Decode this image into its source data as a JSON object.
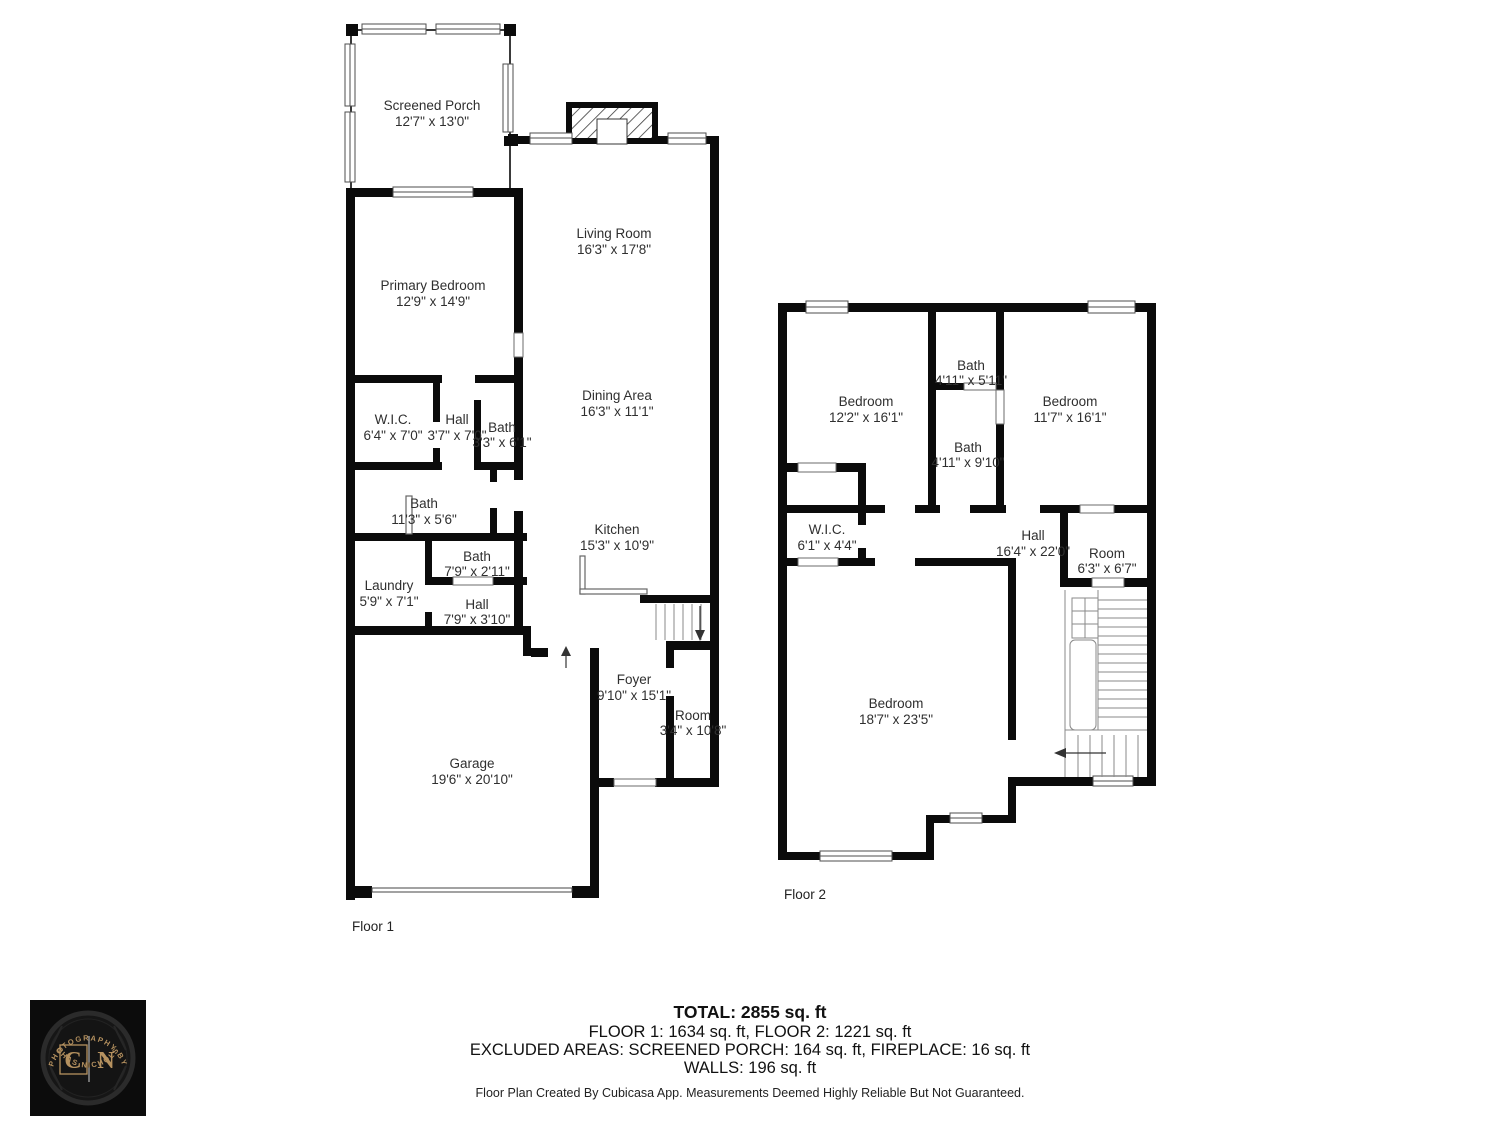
{
  "floor1": {
    "label": "Floor 1",
    "rooms": {
      "screened_porch": {
        "name": "Screened Porch",
        "dims": "12'7\" x 13'0\""
      },
      "primary_bedroom": {
        "name": "Primary Bedroom",
        "dims": "12'9\" x 14'9\""
      },
      "living_room": {
        "name": "Living Room",
        "dims": "16'3\" x 17'8\""
      },
      "dining_area": {
        "name": "Dining Area",
        "dims": "16'3\" x 11'1\""
      },
      "kitchen": {
        "name": "Kitchen",
        "dims": "15'3\" x 10'9\""
      },
      "wic": {
        "name": "W.I.C.",
        "dims": "6'4\" x 7'0\""
      },
      "hall1": {
        "name": "Hall",
        "dims": "3'7\" x 7'0\""
      },
      "bath1": {
        "name": "Bath",
        "dims": "3'3\" x 6'1\""
      },
      "bath2": {
        "name": "Bath",
        "dims": "11'3\" x 5'6\""
      },
      "bath3": {
        "name": "Bath",
        "dims": "7'9\" x 2'11\""
      },
      "laundry": {
        "name": "Laundry",
        "dims": "5'9\" x 7'1\""
      },
      "hall2": {
        "name": "Hall",
        "dims": "7'9\" x 3'10\""
      },
      "foyer": {
        "name": "Foyer",
        "dims": "9'10\" x 15'1\""
      },
      "room": {
        "name": "Room",
        "dims": "3'4\" x 10'8\""
      },
      "garage": {
        "name": "Garage",
        "dims": "19'6\" x 20'10\""
      }
    }
  },
  "floor2": {
    "label": "Floor 2",
    "rooms": {
      "bedroom1": {
        "name": "Bedroom",
        "dims": "12'2\" x 16'1\""
      },
      "bath_small": {
        "name": "Bath",
        "dims": "4'11\" x 5'11\""
      },
      "bath_large": {
        "name": "Bath",
        "dims": "4'11\" x 9'10\""
      },
      "bedroom2": {
        "name": "Bedroom",
        "dims": "11'7\" x 16'1\""
      },
      "wic": {
        "name": "W.I.C.",
        "dims": "6'1\" x 4'4\""
      },
      "hall": {
        "name": "Hall",
        "dims": "16'4\" x 22'0\""
      },
      "room": {
        "name": "Room",
        "dims": "6'3\" x 6'7\""
      },
      "bedroom3": {
        "name": "Bedroom",
        "dims": "18'7\" x 23'5\""
      }
    }
  },
  "summary": {
    "total": "TOTAL: 2855 sq. ft",
    "floors": "FLOOR 1: 1634 sq. ft, FLOOR 2: 1221 sq. ft",
    "excluded": "EXCLUDED AREAS: SCREENED PORCH: 164 sq. ft, FIREPLACE: 16 sq. ft",
    "walls": "WALLS: 196 sq. ft",
    "disclaimer": "Floor Plan Created By Cubicasa App. Measurements Deemed Highly Reliable But Not Guaranteed."
  },
  "logo": {
    "top_arc": "PHOTOGRAPHY BY",
    "bottom_arc": "CHAS NICHOLS",
    "initial_left": "C",
    "initial_right": "N",
    "colors": {
      "gold": "#b5915f",
      "background": "#0c0c0c"
    }
  },
  "colors": {
    "wall": "#0b0b0b",
    "paper": "#ffffff"
  }
}
